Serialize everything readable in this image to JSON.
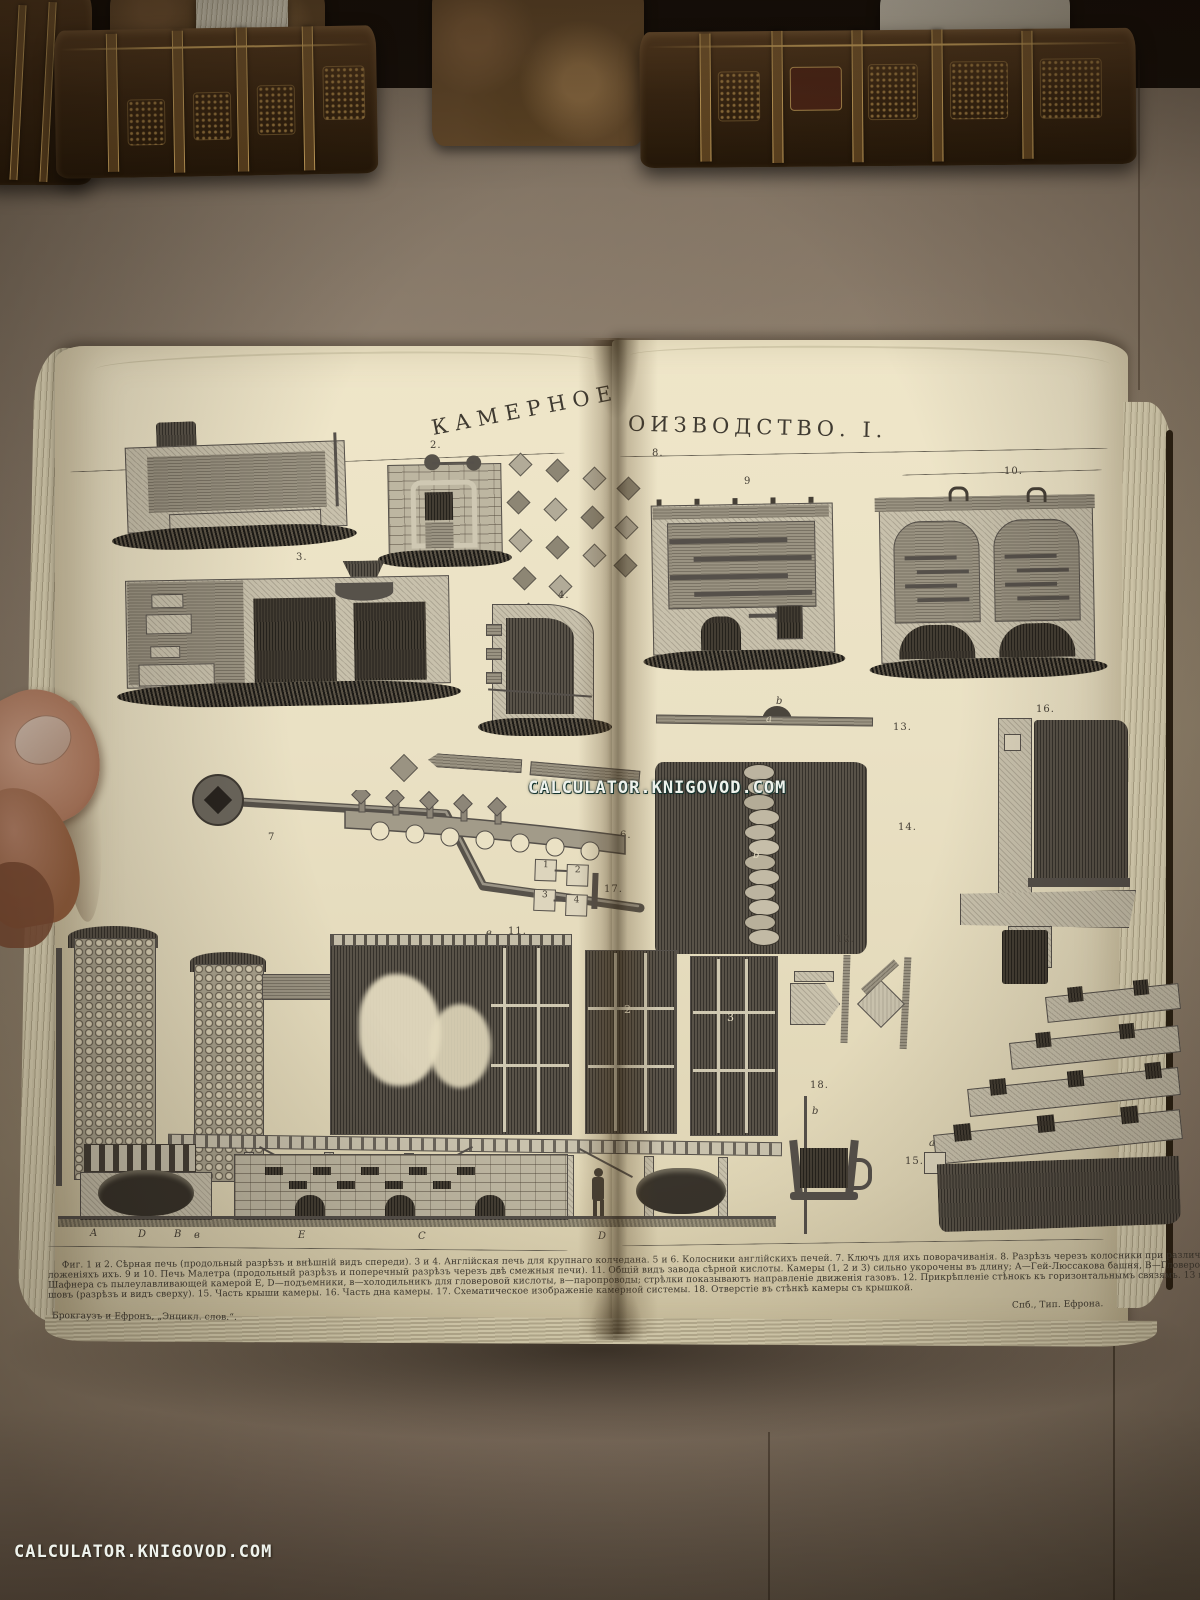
{
  "watermarks": {
    "center": "CALCULATOR.KNIGOVOD.COM",
    "bottom_left": "CALCULATOR.KNIGOVOD.COM"
  },
  "plate": {
    "title": {
      "part1": "КАМЕРНОЕ",
      "part2": "ОИЗВОДСТВО. I.",
      "full": "КАМЕРНОЕ ПРОИЗВОДСТВО. I."
    },
    "imprint_left": "Брокгаузъ и Ефронъ, „Энцикл. слов.“.",
    "imprint_right": "Спб., Тип. Ефрона.",
    "caption": {
      "line1": "Фиг. 1 и 2. Сѣрная печь (продольный разрѣзъ и внѣшній видъ спереди). 3 и 4. Англійская печь для крупнаго колчедана. 5 и 6. Колосники англійскихъ печей. 7. Ключъ для ихъ поворачиванія. 8. Разрѣзъ черезъ колосники при различныхъ по-",
      "line2": "ложеніяхъ ихъ. 9 и 10. Печь Малетра (продольный разрѣзъ и поперечный разрѣзъ черезъ двѣ смежныя печи). 11. Общій видъ завода сѣрной кислоты. Камеры (1, 2 и 3) сильно укорочены въ длину; А—Гей-Люссакова башня, В—Гловерова башня, С—печь",
      "line3": "Шафнера съ пылеулавливающей камерой Е, D—подъемники, в—холодильникъ для гловеровой кислоты, в—паропроводы; стрѣлки показываютъ направленіе движенія газовъ. 12. Прикрѣпленіе стѣнокъ къ горизонтальнымъ связямъ. 13 и 14. Свинцовый",
      "line4": "шовъ (разрѣзъ и видъ сверху). 15. Часть крыши камеры. 16. Часть дна камеры. 17. Схематическое изображеніе камерной системы. 18. Отверстіе въ стѣнкѣ камеры съ крышкой."
    },
    "figures": {
      "fig2": "2.",
      "fig3": "3.",
      "fig4": "4.",
      "fig6": "6.",
      "fig7": "7",
      "fig8": "8.",
      "fig9": "9",
      "fig10": "10.",
      "fig11": "11.",
      "fig11_prefix": "в",
      "fig12": "12.",
      "fig13": "13.",
      "fig14": "14.",
      "fig15": "15.",
      "fig16": "16.",
      "fig17": "17.",
      "fig18": "18.",
      "letters": {
        "fig13_b": "b",
        "fig13_a": "a",
        "fig14_b": "b",
        "fig18_b": "b",
        "fig15_a": "a"
      },
      "chamber_labels": [
        "2",
        "3"
      ],
      "baseline_letters": [
        "A",
        "D",
        "B",
        "в",
        "E",
        "C",
        "D"
      ],
      "scheme_cells": [
        "1",
        "2",
        "3",
        "4"
      ]
    }
  },
  "colors": {
    "page_cream": "#eae1c4",
    "kraft_paper": "#8d7e6c",
    "leather_brown": "#3d2914",
    "gold_tooling": "#b8914f",
    "engraving_ink": "#453f36",
    "watermark_text": "#eef2ec"
  }
}
